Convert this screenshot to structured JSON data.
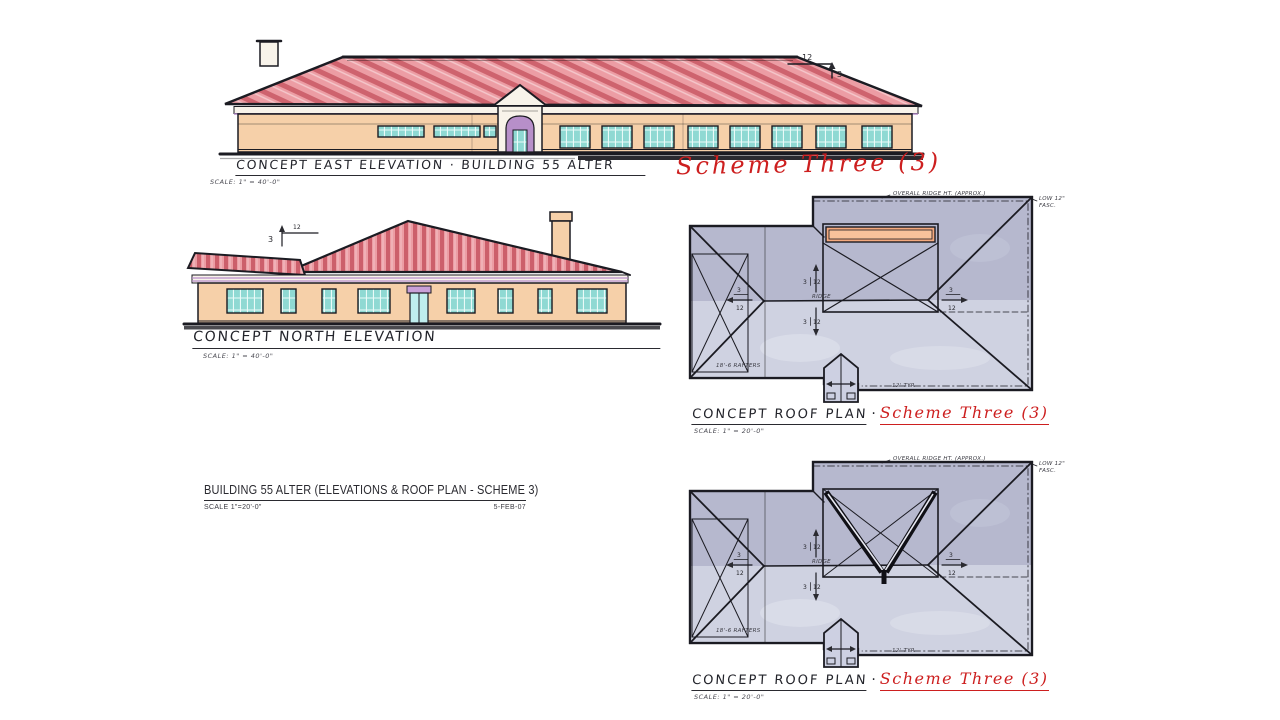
{
  "colors": {
    "paper": "#ffffff",
    "ink": "#1b1b22",
    "roof_pink": "#ec9da4",
    "roof_stripe": "#c4505c",
    "wall_peach": "#f6d0a9",
    "trim_cream": "#f8f3ea",
    "window_teal": "#8fd9d3",
    "accent_purple": "#b78fc9",
    "door_purple": "#c9a0d8",
    "plan_gray": "#b6b8ce",
    "plan_light": "#d6d8e6",
    "porch_gray": "#cdd0e2",
    "strip_orange": "#f4a97e",
    "marker_red": "#cd1f1f",
    "ground_dark": "#2a2a30"
  },
  "east_elevation": {
    "title": "CONCEPT EAST ELEVATION · BUILDING 55 ALTER",
    "scheme_label": "Scheme Three (3)",
    "scale_note": "SCALE: 1\" = 40'-0\"",
    "pitch_run": "12",
    "pitch_rise": "3"
  },
  "north_elevation": {
    "title": "CONCEPT NORTH ELEVATION",
    "scale_note": "SCALE: 1\" = 40'-0\"",
    "pitch_rise": "3",
    "pitch_run": "12"
  },
  "roof_plans": {
    "top": {
      "title": "CONCEPT ROOF PLAN",
      "separator": "·",
      "scheme_label": "Scheme Three (3)",
      "scale_note": "SCALE: 1\" = 20'-0\""
    },
    "bottom": {
      "title": "CONCEPT ROOF PLAN",
      "separator": "·",
      "scheme_label": "Scheme Three (3)",
      "scale_note": "SCALE: 1\" = 20'-0\""
    },
    "annotations": {
      "overall_ridge": "OVERALL RIDGE HT. (APPROX.)",
      "low_fascia_line1": "LOW 12\"",
      "low_fascia_line2": "FASC.",
      "rafters": "18'-6 RAFTERS",
      "typical": "12' TYP.",
      "ridge": "RIDGE",
      "slope_rise": "3",
      "slope_run": "12"
    }
  },
  "title_block": {
    "title": "BUILDING 55 ALTER (ELEVATIONS & ROOF PLAN - SCHEME 3)",
    "scale_note": "SCALE 1\"=20'-0\"",
    "date": "5-FEB-07"
  }
}
